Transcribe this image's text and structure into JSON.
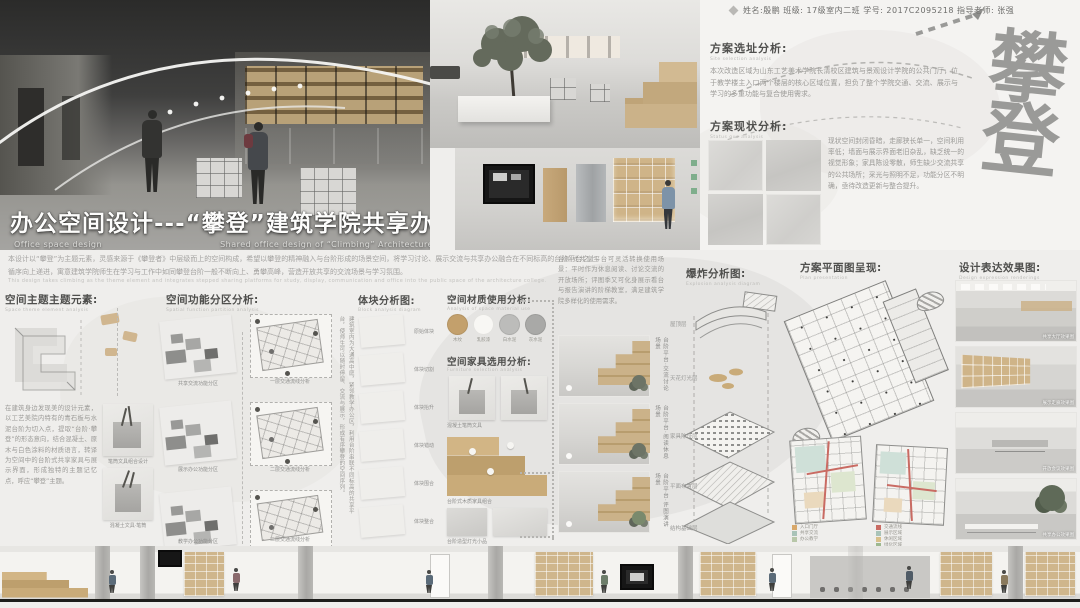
{
  "header": {
    "student_info": "姓名:殷鹏  班级: 17级室内二班  学号: 2017C2095218  指导老师: 张强"
  },
  "title": {
    "main": "办公空间设计---“攀登”建筑学院共享办公设计",
    "en_left": "Office space design",
    "en_right": "Shared office design of “Climbing” Architecture College"
  },
  "intro": {
    "line1": "本设计以“攀登”为主题元素，灵感来源于《攀登者》中层级而上的空间构成，希望以攀登的精神融入与台阶形成的场景空间，将学习讨论、展示交流与共享办公融合在不同标高的台阶平台之上，",
    "line2": "循序向上递进，寓意建筑学院师生在学习与工作中如同攀登台阶一般不断向上、勇攀高峰，营造开放共享的交流场景与学习氛围。",
    "en": "This design takes climbing as the theme element and integrates stepped sharing platforms for study, display, communication and office into the public space of the architecture college."
  },
  "site": {
    "heading": "方案选址分析:",
    "en": "Site selection analysis",
    "body": "本次改造区域为山东工艺美术学院长清校区建筑与景观设计学院的公共门厅，位于教学楼主入口两个楼层的核心区域位置，担负了整个学院交通、交流、展示与学习的多重功能与复合使用需求。"
  },
  "status": {
    "heading": "方案现状分析:",
    "en": "Status quo analysis",
    "body": "现状空间封闭昏暗，走廊狭长单一，空间利用率低；墙面与展示界面老旧杂乱，缺乏统一的视觉形象；家具陈设零散，师生缺少交流共享的公共场所；采光与照明不足，功能分区不明确，亟待改造更新与整合提升。"
  },
  "calligraphy": "攀登",
  "theme": {
    "heading": "空间主题主题元素:",
    "en": "Space theme element analysis",
    "body": "在建筑身边发现美的设计元素，以工艺美院内特有的青石板与水泥台阶为切入点，提取“台阶·攀登”的形态意向，结合混凝土、原木与白色涂料的材质语言，转译为空间中的台阶式共享家具与展示界面，形成独特的主题记忆点，呼应“攀登”主题。",
    "captions": [
      "笔筒文具组合设计",
      "混凝土文具·笔筒"
    ]
  },
  "zoning": {
    "heading": "空间功能分区分析:",
    "en": "Spatial function partition analysis",
    "zone_captions": [
      "共享交流功能分区",
      "展示办公功能分区",
      "教学办公功能分区"
    ],
    "flow_captions": [
      "一层交通流线分析",
      "二层交通流线分析",
      "三层交通流线分析"
    ],
    "note": "建筑室内为大通高中庭，紧邻教学办公区，利用台阶串联不同标高的共享平台，使师生可以随时停留、交流与展示，形成有序攀登的空间序列。"
  },
  "blocks": {
    "heading": "体块分析图:",
    "en": "Block analysis diagram",
    "captions": [
      "原始体块",
      "体块切割",
      "体块抬升",
      "体块错动",
      "体块围合",
      "体块整合"
    ]
  },
  "materials": {
    "heading": "空间材质使用分析:",
    "en": "Analysis of space material use",
    "items": [
      {
        "label": "木纹",
        "color": "#c3a06c"
      },
      {
        "label": "乳胶漆",
        "color": "#f8f7f4"
      },
      {
        "label": "白水泥",
        "color": "#bcbcba"
      },
      {
        "label": "灰水泥",
        "color": "#a9a9a7"
      }
    ]
  },
  "furniture": {
    "heading": "空间家具选用分析:",
    "en": "Furniture selection analysis",
    "captions": [
      "混凝土笔筒文具",
      "台阶式木质家具组合",
      "台阶造型灯光小品"
    ]
  },
  "scenes": {
    "body": "台阶式共享平台可灵活转换使用场景：平时作为休息阅读、讨论交流的开放场所；评图季又可化身展示看台与报告演讲的阶梯教室，满足建筑学院多样化的使用需求。",
    "captions": [
      "台阶平台·交流讨论场景",
      "台阶平台·阅读休息场景",
      "台阶平台·评图演讲场景"
    ]
  },
  "explode": {
    "heading": "爆炸分析图:",
    "en": "Explosion analysis diagram",
    "layers": [
      "屋顶层",
      "天花灯光层",
      "家具陈设层",
      "平面布置层",
      "结构基础层"
    ]
  },
  "plans": {
    "heading": "方案平面图呈现:",
    "en": "Plan presentation",
    "legend_a": [
      {
        "label": "入口门厅",
        "color": "#d8a86a"
      },
      {
        "label": "共享交流",
        "color": "#a9c3b8"
      },
      {
        "label": "办公教学",
        "color": "#b8c7a9"
      }
    ],
    "legend_b": [
      {
        "label": "交通流线",
        "color": "#c96b63"
      },
      {
        "label": "展示区域",
        "color": "#a9c3b8"
      },
      {
        "label": "休闲区域",
        "color": "#d8c08a"
      },
      {
        "label": "绿化区域",
        "color": "#9db88f"
      }
    ]
  },
  "renders": {
    "heading": "设计表达效果图:",
    "en": "Design expression renderings",
    "captions": [
      "共享大厅效果图",
      "展示走廊效果图",
      "开放会议效果图",
      "共享办公效果图"
    ]
  },
  "colors": {
    "wood": "#c9a979",
    "flow_red": "#c96b63",
    "poster_bg": "#efeeec",
    "ink_gray": "#8e8e8c"
  }
}
